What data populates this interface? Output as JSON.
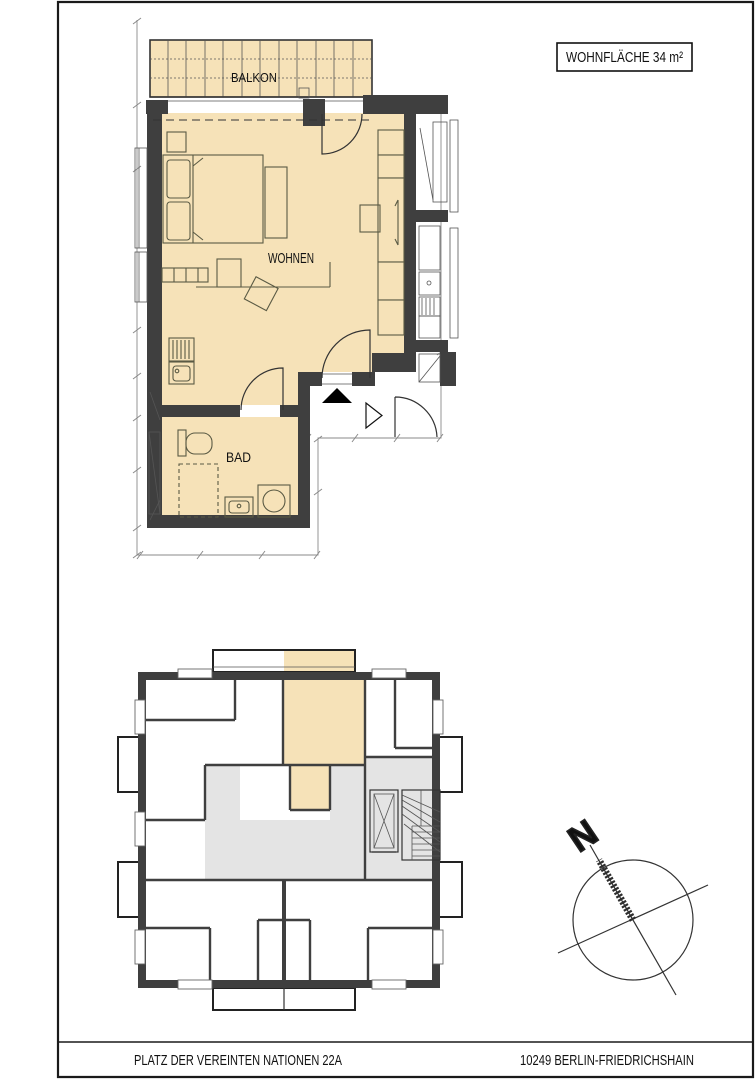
{
  "area_label": {
    "text": "WOHNFLÄCHE 34 m²"
  },
  "floor_plan": {
    "rooms": [
      {
        "label": "BALKON"
      },
      {
        "label": "WOHNEN"
      },
      {
        "label": "BAD"
      }
    ]
  },
  "compass": {
    "north_label": "N"
  },
  "footer": {
    "address": "PLATZ DER VEREINTEN NATIONEN 22A",
    "city": "10249 BERLIN-FRIEDRICHSHAIN"
  },
  "colors": {
    "apartment_fill": "#f6e2b8",
    "corridor_fill": "#e4e4e4",
    "wall": "#3f3f3f",
    "line": "#333333",
    "background": "#ffffff"
  }
}
